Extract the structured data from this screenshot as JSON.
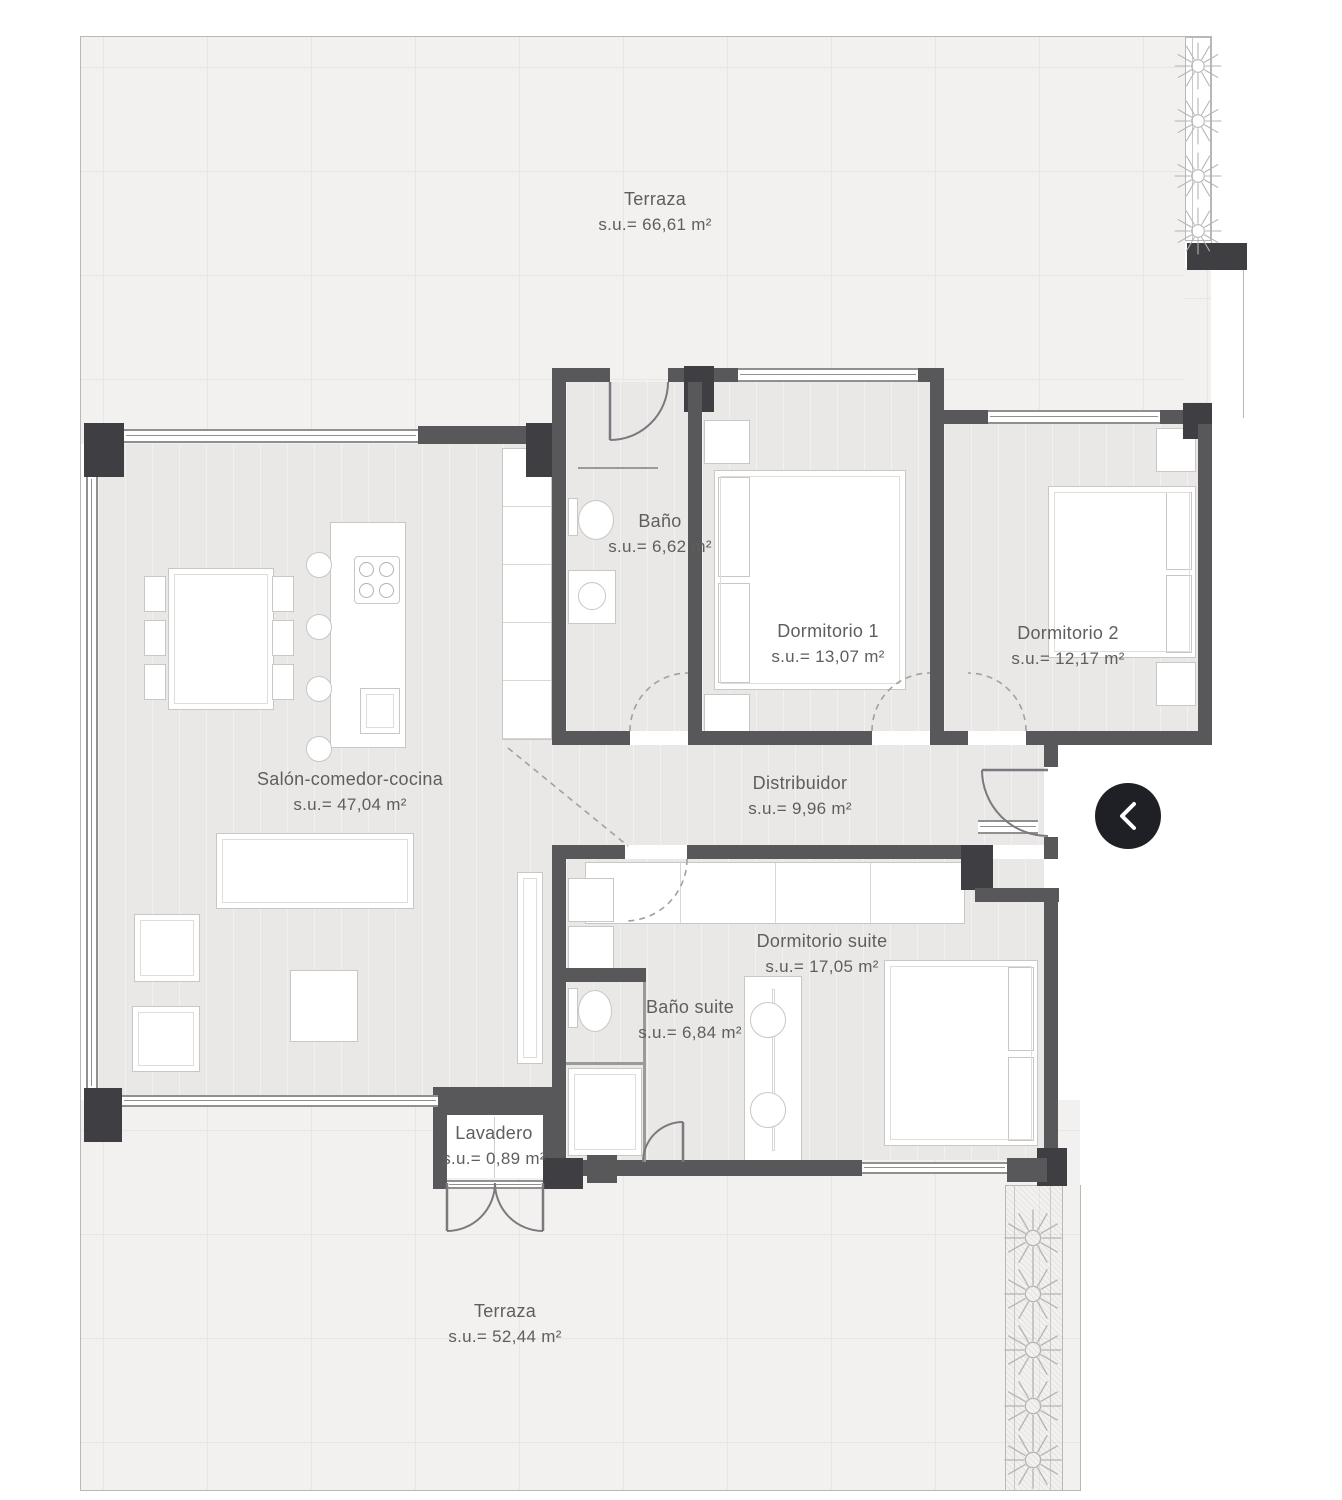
{
  "title": "Apartment floor plan",
  "rooms": [
    {
      "id": "terraza-top",
      "name": "Terraza",
      "area": "s.u.= 66,61 m²"
    },
    {
      "id": "bano",
      "name": "Baño",
      "area": "s.u.= 6,62 m²"
    },
    {
      "id": "dormitorio-1",
      "name": "Dormitorio 1",
      "area": "s.u.= 13,07 m²"
    },
    {
      "id": "dormitorio-2",
      "name": "Dormitorio 2",
      "area": "s.u.= 12,17 m²"
    },
    {
      "id": "salon",
      "name": "Salón-comedor-cocina",
      "area": "s.u.= 47,04 m²"
    },
    {
      "id": "distribuidor",
      "name": "Distribuidor",
      "area": "s.u.= 9,96 m²"
    },
    {
      "id": "dormitorio-suite",
      "name": "Dormitorio suite",
      "area": "s.u.= 17,05 m²"
    },
    {
      "id": "bano-suite",
      "name": "Baño suite",
      "area": "s.u.= 6,84 m²"
    },
    {
      "id": "lavadero",
      "name": "Lavadero",
      "area": "s.u.= 0,89 m²"
    },
    {
      "id": "terraza-bottom",
      "name": "Terraza",
      "area": "s.u.= 52,44 m²"
    }
  ],
  "carousel": {
    "prev_icon": "chevron-left"
  },
  "colors": {
    "wall": "#58585a",
    "wall_dark": "#3f3e42",
    "floor": "#e9e8e6",
    "terrace": "#f2f1ef",
    "grid_line": "#e7e6e3",
    "boundary_line": "#b9b8b6",
    "furniture_line": "#c8c7c4",
    "door_arc": "#7a797d",
    "dashed_line": "#a2a19e",
    "label_text": "#5f5e5c",
    "button_bg": "#1f2025",
    "button_icon": "#ffffff"
  }
}
